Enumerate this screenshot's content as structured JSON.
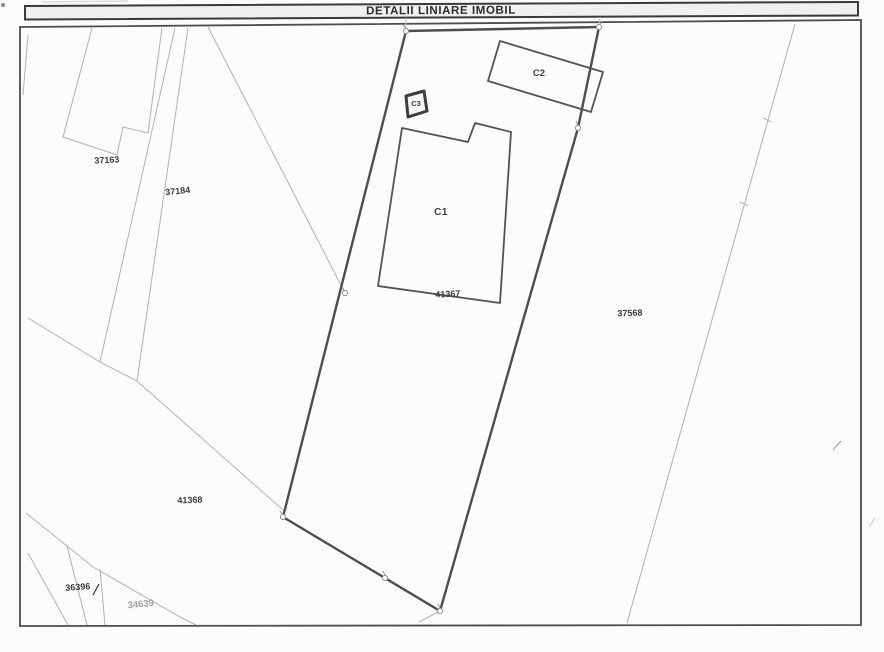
{
  "title_bar": {
    "title": "DETALII LINIARE IMOBIL"
  },
  "map": {
    "parcel_labels": [
      {
        "number": "37163"
      },
      {
        "number": "37184"
      },
      {
        "number": "41367"
      },
      {
        "number": "37568"
      },
      {
        "number": "41368"
      },
      {
        "number": "36396"
      },
      {
        "number": "34639"
      }
    ],
    "building_labels": [
      {
        "code": "C1"
      },
      {
        "code": "C2"
      },
      {
        "code": "C3"
      }
    ],
    "colors": {
      "paper": "#fcfcfa",
      "frame": "#4f4d4b",
      "main_parcel_outline": "#4e4e4e",
      "building_outline": "#555351",
      "neighbor_boundary": "#b3b1ae",
      "label_dark": "#3d3c3a",
      "label_faded": "#a5a39f",
      "title_band_fill": "#f1f0ee",
      "title_band_border": "#3b3a38"
    }
  }
}
